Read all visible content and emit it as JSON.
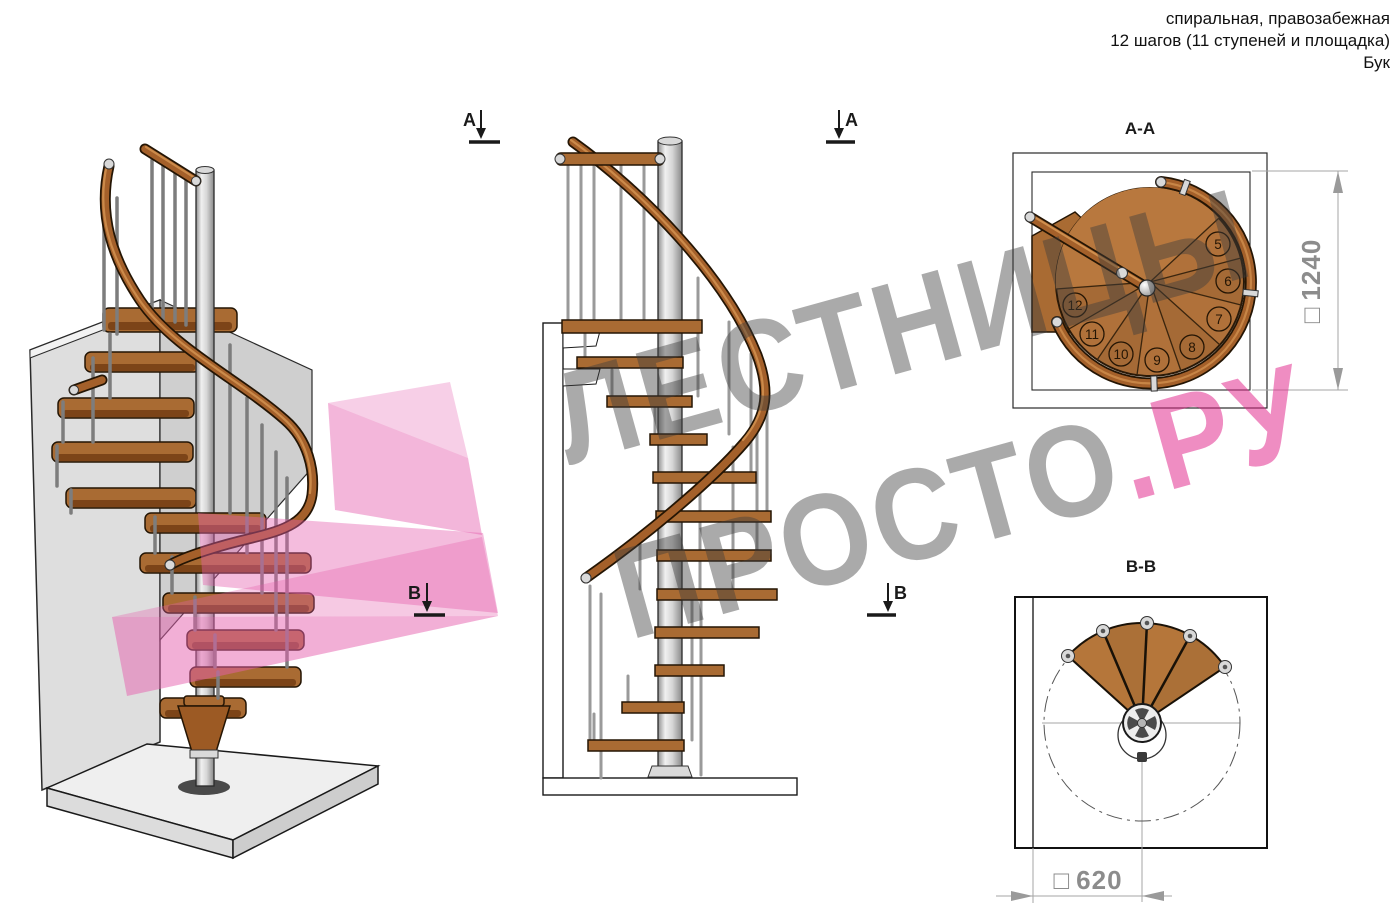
{
  "header": {
    "line1": "спиральная, правозабежная",
    "line2": "12 шагов (11 ступеней и площадка)",
    "line3": "Бук"
  },
  "markers": {
    "a": "A",
    "b": "B"
  },
  "sections": {
    "aa": {
      "title": "A-A",
      "dim_symbol": "□",
      "dim_value": "1240",
      "steps": [
        "5",
        "6",
        "7",
        "8",
        "9",
        "10",
        "11",
        "12"
      ]
    },
    "bb": {
      "title": "B-B",
      "dim_symbol": "□",
      "dim_value": "620",
      "steps": [
        "1",
        "2",
        "3",
        "4"
      ]
    }
  },
  "watermark": {
    "word1": "ЛЕСТНИЦЫ",
    "word2": "ПРОСТО",
    "word3": ".РУ"
  },
  "colors": {
    "wood": "#a96b33",
    "wood_dark": "#7c4418",
    "handrail": "#a4602a",
    "metal": "#d9d9d9",
    "wall": "#dedede",
    "watermark_gray": "#a9a9a9",
    "watermark_pink": "#ef8fc3",
    "pink_shape": "#e560ae",
    "dim_gray": "#8c8c8c"
  }
}
